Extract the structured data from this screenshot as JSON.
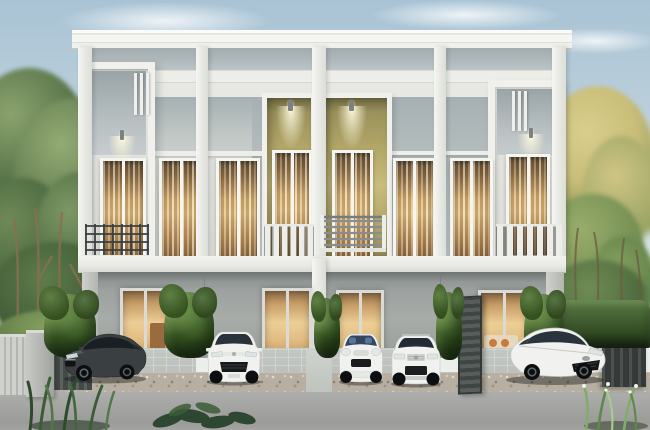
{
  "meta": {
    "kind": "architectural-rendering-photo",
    "subject": "Modern two-storey townhouse row at dusk with warm interior lighting, five parked cars, trimmed hedges and trees",
    "width_px": 650,
    "height_px": 430
  },
  "palette": {
    "sky_top": "#a9c3d5",
    "sky_bottom": "#e9eeec",
    "band_grey": "#aeb8bb",
    "wall_white": "#e7e8e3",
    "panel_grey": "#c2c8c6",
    "accent_olive": "#b3a768",
    "accent_olive_dark": "#968c58",
    "window_frame": "#f5f5f1",
    "window_glow_light": "#e3c286",
    "window_glow_dark": "#5c4a32",
    "slab_white": "#e9eae5",
    "ground_wall_light": "#a7aca9",
    "hedge_light": "#5d7c44",
    "hedge_dark": "#22351a",
    "tree_green_light": "#8aa36d",
    "tree_green_dark": "#4a6640",
    "tree_gold": "#c9bd79",
    "trunk_brown": "#8a6f52",
    "apron_tile": "#bcc0bc",
    "gravel": "#b7afa2",
    "road_grey": "#a3a3a1",
    "pillar_grey": "#b3b6b0",
    "gate_dark": "#353a38",
    "railing_dark": "#3a3f41",
    "railing_grey": "#888d8f",
    "car_dark_body": "#3a3f42",
    "car_white_body": "#f1f2ef",
    "car_glass_dark": "#20262b",
    "wheel_black": "#0d0e0f",
    "sofa_orange": "#c97a3f",
    "interior_wood": "#9a6b3f"
  },
  "scene": {
    "building": {
      "storeys": 2,
      "units": 4,
      "upper_windows": 8,
      "ground_doors": 4,
      "balconies": 4,
      "features": [
        "flat white roof slab",
        "grey clerestory panel band under roof",
        "olive-green recessed porches at centre with downlights",
        "white protruding window boxes with louvres on end units",
        "dark steel grid balcony on left unit",
        "white slat balconies on centre and right units",
        "warm glowing curtained interiors"
      ]
    },
    "vehicles": [
      {
        "name": "dark-grey-sedan",
        "position": "far left bay"
      },
      {
        "name": "white-compact-hatchback",
        "position": "second bay"
      },
      {
        "name": "white-mini-hatchback",
        "position": "third bay left"
      },
      {
        "name": "white-compact-suv",
        "position": "third bay right"
      },
      {
        "name": "white-sedan",
        "position": "right bay"
      }
    ],
    "landscape": {
      "left": "tall green trees, lawn mound, grey gate pillar and fence",
      "right": "sun-lit golden trees over a trimmed hedge with dark metal gate",
      "foreground": "concrete driveway, gravel strip, ornamental grasses"
    }
  }
}
